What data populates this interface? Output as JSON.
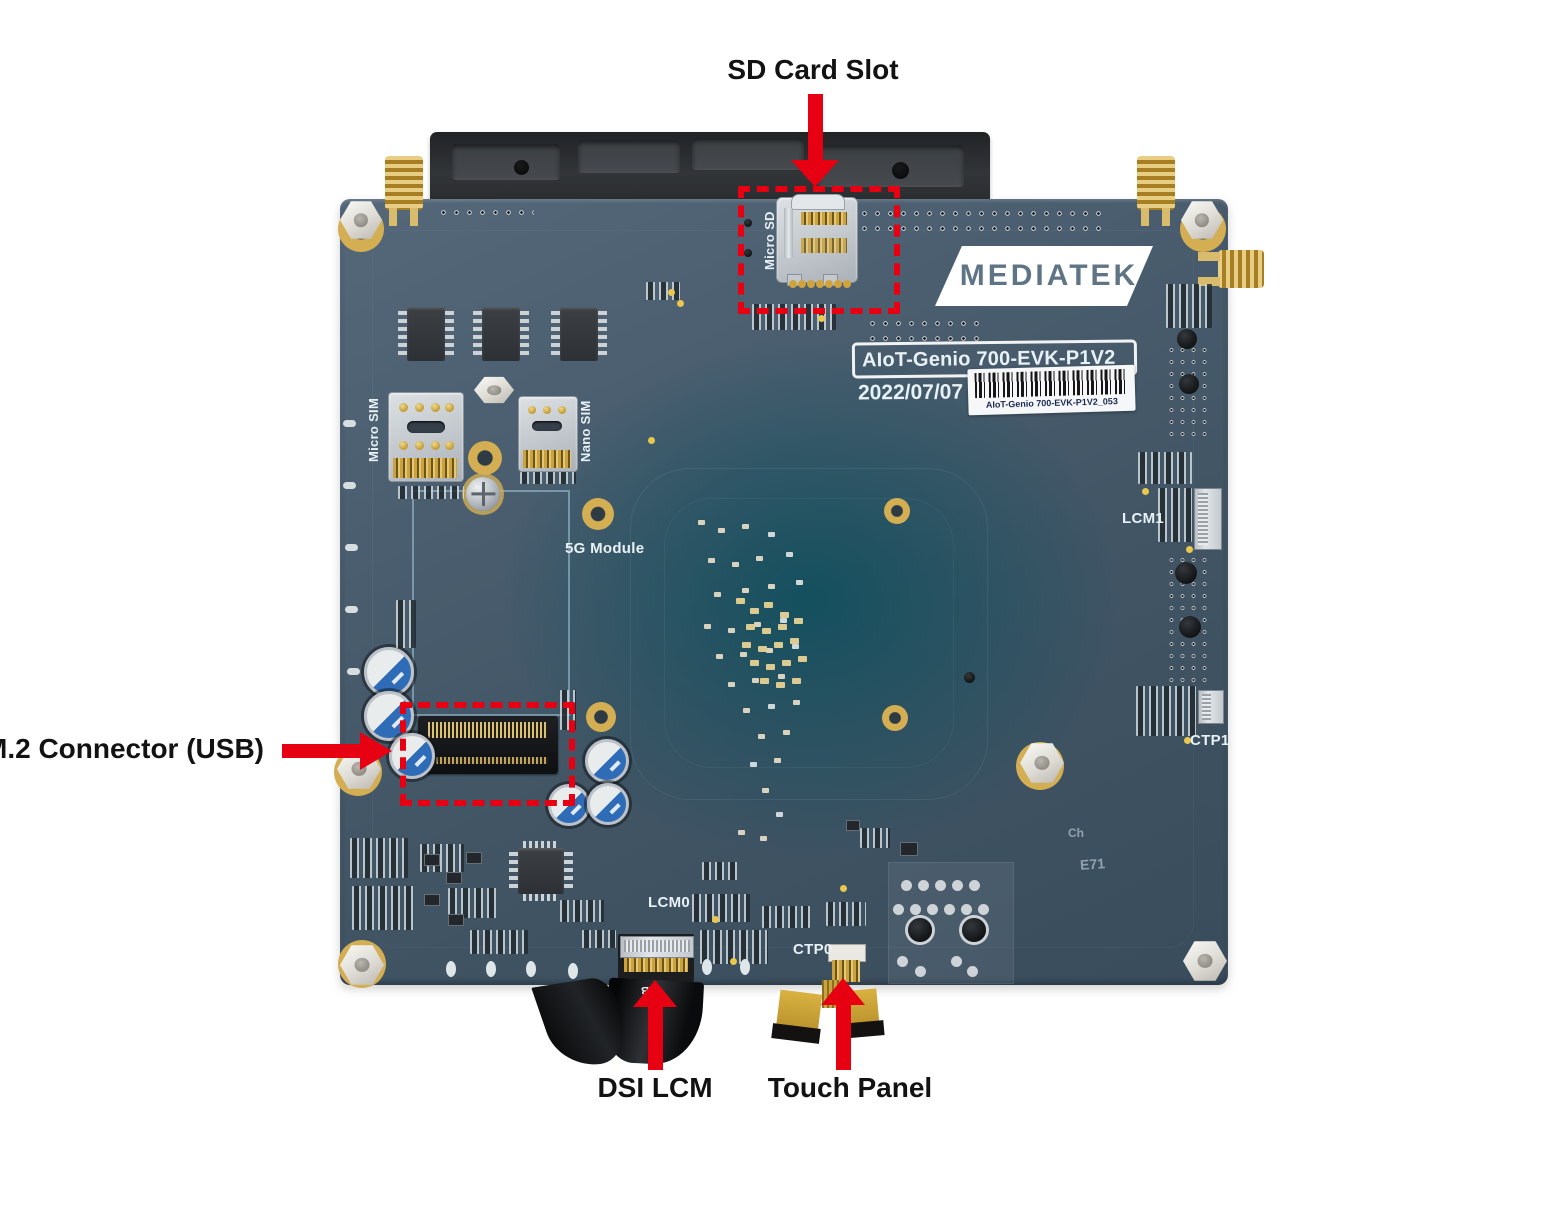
{
  "annotations": {
    "sd": {
      "label": "SD Card Slot"
    },
    "m2": {
      "label": "M.2 Connector (USB)"
    },
    "dsi": {
      "label": "DSI LCM"
    },
    "touch": {
      "label": "Touch Panel"
    },
    "arrow_color": "#e60012"
  },
  "board": {
    "logo": "MEDIATEK",
    "model": "AIoT-Genio 700-EVK-P1V2",
    "date": "2022/07/07",
    "barcode": "AIoT-Genio 700-EVK-P1V2_053",
    "silk": {
      "micro_sd": "Micro SD",
      "micro_sim": "Micro SIM",
      "nano_sim": "Nano SIM",
      "module_5g": "5G Module",
      "lcm0": "LCM0",
      "ctp0": "CTP0",
      "lcm1": "LCM1",
      "ctp1": "CTP1",
      "ribbon_mb": "MB",
      "etch_a": "Ch",
      "etch_b": "E71"
    },
    "colors": {
      "pcb": "#46596a",
      "pcb_center": "#14525f",
      "silkscreen": "#e8f1f5",
      "gold": "#c9a23f",
      "annotation_red": "#e60012"
    }
  }
}
